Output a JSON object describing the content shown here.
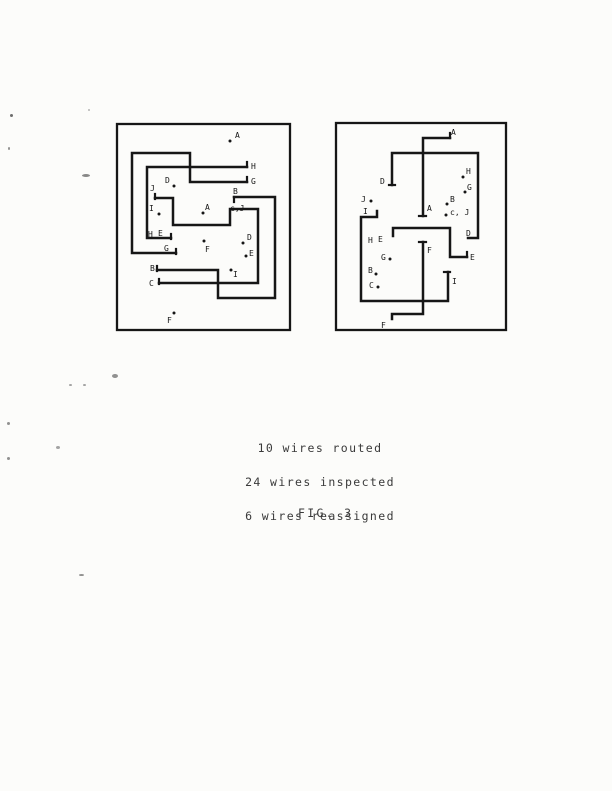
{
  "page": {
    "width": 612,
    "height": 791,
    "background": "#fcfcfa"
  },
  "figure": {
    "ink": "#161616",
    "caption": [
      "10 wires routed",
      "24 wires inspected",
      "6 wires reassigned"
    ],
    "fig_label": "FIG. 3",
    "stats": {
      "wires_routed": 10,
      "wires_inspected": 24,
      "wires_reassigned": 6
    },
    "diagrams": [
      {
        "name": "left-wiring-diagram",
        "box": [
          117,
          124,
          173,
          206
        ],
        "wires": [
          {
            "net": "H",
            "points": [
              [
                247,
                167
              ],
              [
                147,
                167
              ],
              [
                147,
                238
              ],
              [
                171,
                238
              ]
            ]
          },
          {
            "net": "G",
            "points": [
              [
                176,
                253
              ],
              [
                132,
                253
              ],
              [
                132,
                153
              ],
              [
                190,
                153
              ],
              [
                190,
                182
              ],
              [
                247,
                182
              ]
            ]
          },
          {
            "net": "B",
            "points": [
              [
                157,
                270
              ],
              [
                218,
                270
              ],
              [
                218,
                298
              ],
              [
                275,
                298
              ],
              [
                275,
                197
              ],
              [
                234,
                197
              ]
            ]
          },
          {
            "net": "C-J",
            "points": [
              [
                155,
                198
              ],
              [
                173,
                198
              ],
              [
                173,
                225
              ],
              [
                230,
                225
              ],
              [
                230,
                209
              ],
              [
                258,
                209
              ],
              [
                258,
                283
              ],
              [
                159,
                283
              ]
            ]
          }
        ],
        "ticks": [
          [
            247,
            162,
            247,
            167
          ],
          [
            247,
            177,
            247,
            182
          ],
          [
            171,
            234,
            171,
            239
          ],
          [
            176,
            249,
            176,
            254
          ],
          [
            157,
            266,
            157,
            271
          ],
          [
            234,
            197,
            234,
            202
          ],
          [
            155,
            194,
            155,
            199
          ],
          [
            159,
            279,
            159,
            284
          ]
        ],
        "dots": [
          [
            230,
            141
          ],
          [
            174,
            186
          ],
          [
            159,
            214
          ],
          [
            203,
            213
          ],
          [
            204,
            241
          ],
          [
            243,
            243
          ],
          [
            246,
            256
          ],
          [
            231,
            270
          ],
          [
            174,
            313
          ]
        ],
        "labels": [
          {
            "t": "A",
            "x": 235,
            "y": 138
          },
          {
            "t": "H",
            "x": 251,
            "y": 169
          },
          {
            "t": "G",
            "x": 251,
            "y": 184
          },
          {
            "t": "D",
            "x": 165,
            "y": 183
          },
          {
            "t": "J",
            "x": 150,
            "y": 191
          },
          {
            "t": "I",
            "x": 149,
            "y": 211
          },
          {
            "t": "B",
            "x": 233,
            "y": 194
          },
          {
            "t": "A",
            "x": 205,
            "y": 210
          },
          {
            "t": "c,J",
            "x": 230,
            "y": 211
          },
          {
            "t": "H",
            "x": 148,
            "y": 237
          },
          {
            "t": "E",
            "x": 158,
            "y": 236
          },
          {
            "t": "G",
            "x": 164,
            "y": 251
          },
          {
            "t": "B",
            "x": 150,
            "y": 271
          },
          {
            "t": "C",
            "x": 149,
            "y": 286
          },
          {
            "t": "F",
            "x": 205,
            "y": 252
          },
          {
            "t": "D",
            "x": 247,
            "y": 240
          },
          {
            "t": "E",
            "x": 249,
            "y": 256
          },
          {
            "t": "I",
            "x": 233,
            "y": 277
          },
          {
            "t": "F",
            "x": 167,
            "y": 323
          }
        ]
      },
      {
        "name": "right-wiring-diagram",
        "box": [
          336,
          123,
          170,
          207
        ],
        "wires": [
          {
            "net": "A",
            "points": [
              [
                450,
                138
              ],
              [
                423,
                138
              ],
              [
                423,
                216
              ]
            ]
          },
          {
            "net": "D",
            "points": [
              [
                392,
                185
              ],
              [
                392,
                153
              ],
              [
                478,
                153
              ],
              [
                478,
                238
              ],
              [
                468,
                238
              ]
            ]
          },
          {
            "net": "H-E",
            "points": [
              [
                393,
                236
              ],
              [
                393,
                228
              ],
              [
                450,
                228
              ],
              [
                450,
                257
              ],
              [
                467,
                257
              ]
            ]
          },
          {
            "net": "F",
            "points": [
              [
                423,
                242
              ],
              [
                423,
                314
              ],
              [
                392,
                314
              ],
              [
                392,
                319
              ]
            ]
          },
          {
            "net": "I",
            "points": [
              [
                377,
                211
              ],
              [
                377,
                217
              ],
              [
                361,
                217
              ],
              [
                361,
                301
              ],
              [
                448,
                301
              ],
              [
                448,
                272
              ]
            ]
          }
        ],
        "ticks": [
          [
            450,
            133,
            450,
            138
          ],
          [
            419,
            216,
            426,
            216
          ],
          [
            389,
            185,
            395,
            185
          ],
          [
            467,
            252,
            467,
            257
          ],
          [
            419,
            242,
            426,
            242
          ],
          [
            444,
            272,
            450,
            272
          ]
        ],
        "dots": [
          [
            371,
            201
          ],
          [
            463,
            177
          ],
          [
            465,
            192
          ],
          [
            447,
            204
          ],
          [
            446,
            215
          ],
          [
            390,
            259
          ],
          [
            376,
            274
          ],
          [
            378,
            287
          ]
        ],
        "labels": [
          {
            "t": "A",
            "x": 451,
            "y": 135
          },
          {
            "t": "D",
            "x": 380,
            "y": 184
          },
          {
            "t": "H",
            "x": 466,
            "y": 174
          },
          {
            "t": "G",
            "x": 467,
            "y": 190
          },
          {
            "t": "B",
            "x": 450,
            "y": 202
          },
          {
            "t": "c, J",
            "x": 450,
            "y": 215
          },
          {
            "t": "A",
            "x": 427,
            "y": 211
          },
          {
            "t": "J",
            "x": 361,
            "y": 202
          },
          {
            "t": "I",
            "x": 363,
            "y": 214
          },
          {
            "t": "H",
            "x": 368,
            "y": 243
          },
          {
            "t": "E",
            "x": 378,
            "y": 242
          },
          {
            "t": "G",
            "x": 381,
            "y": 260
          },
          {
            "t": "B",
            "x": 368,
            "y": 273
          },
          {
            "t": "C",
            "x": 369,
            "y": 288
          },
          {
            "t": "D",
            "x": 466,
            "y": 236
          },
          {
            "t": "E",
            "x": 470,
            "y": 260
          },
          {
            "t": "F",
            "x": 427,
            "y": 253
          },
          {
            "t": "I",
            "x": 452,
            "y": 284
          },
          {
            "t": "F",
            "x": 381,
            "y": 328
          }
        ]
      }
    ],
    "specks": [
      [
        10,
        114,
        3,
        3,
        0.8
      ],
      [
        8,
        147,
        2,
        3,
        0.6
      ],
      [
        88,
        109,
        2,
        2,
        0.4
      ],
      [
        82,
        174,
        8,
        3,
        0.65
      ],
      [
        112,
        374,
        6,
        4,
        0.6
      ],
      [
        69,
        384,
        3,
        2,
        0.5
      ],
      [
        83,
        384,
        3,
        2,
        0.5
      ],
      [
        7,
        422,
        3,
        3,
        0.6
      ],
      [
        56,
        446,
        4,
        3,
        0.5
      ],
      [
        7,
        457,
        3,
        3,
        0.6
      ],
      [
        79,
        574,
        5,
        2,
        0.6
      ]
    ]
  }
}
